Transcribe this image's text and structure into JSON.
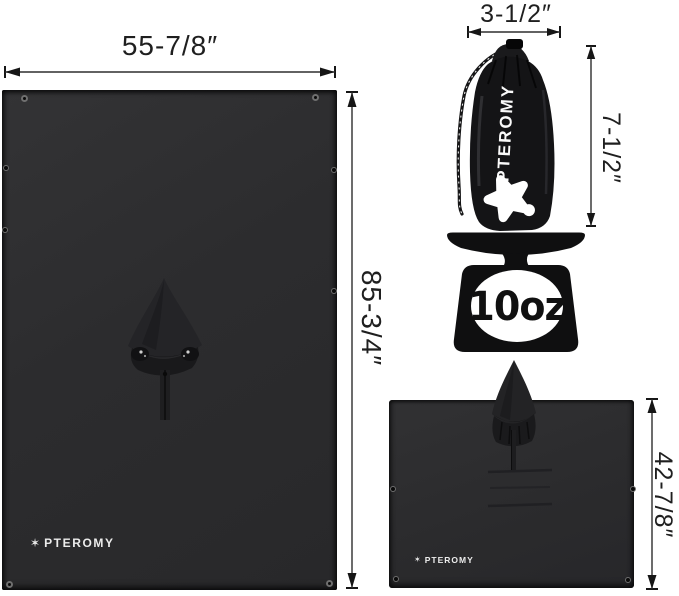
{
  "brand": "PTEROMY",
  "flat_poncho": {
    "width_label": "55-7/8″",
    "height_label": "85-3/4″",
    "logo": "PTEROMY"
  },
  "stuff_sack": {
    "width_label": "3-1/2″",
    "height_label": "7-1/2″",
    "brand_vertical": "PTEROMY"
  },
  "scale": {
    "weight": "10oz"
  },
  "worn_poncho": {
    "height_label": "42-7/8″",
    "logo": "PTEROMY"
  },
  "icons": {
    "star_glyph": "✶",
    "mascot": "flying-squirrel-star-icon",
    "scale": "kitchen-scale-icon"
  },
  "colors": {
    "background": "#ffffff",
    "fabric": "#2c2c2e",
    "fabric_dark": "#1d1d1f",
    "silhouette": "#0f0f10",
    "dimension_text": "#1f1f1f",
    "logo_white": "#f5f5f5"
  }
}
